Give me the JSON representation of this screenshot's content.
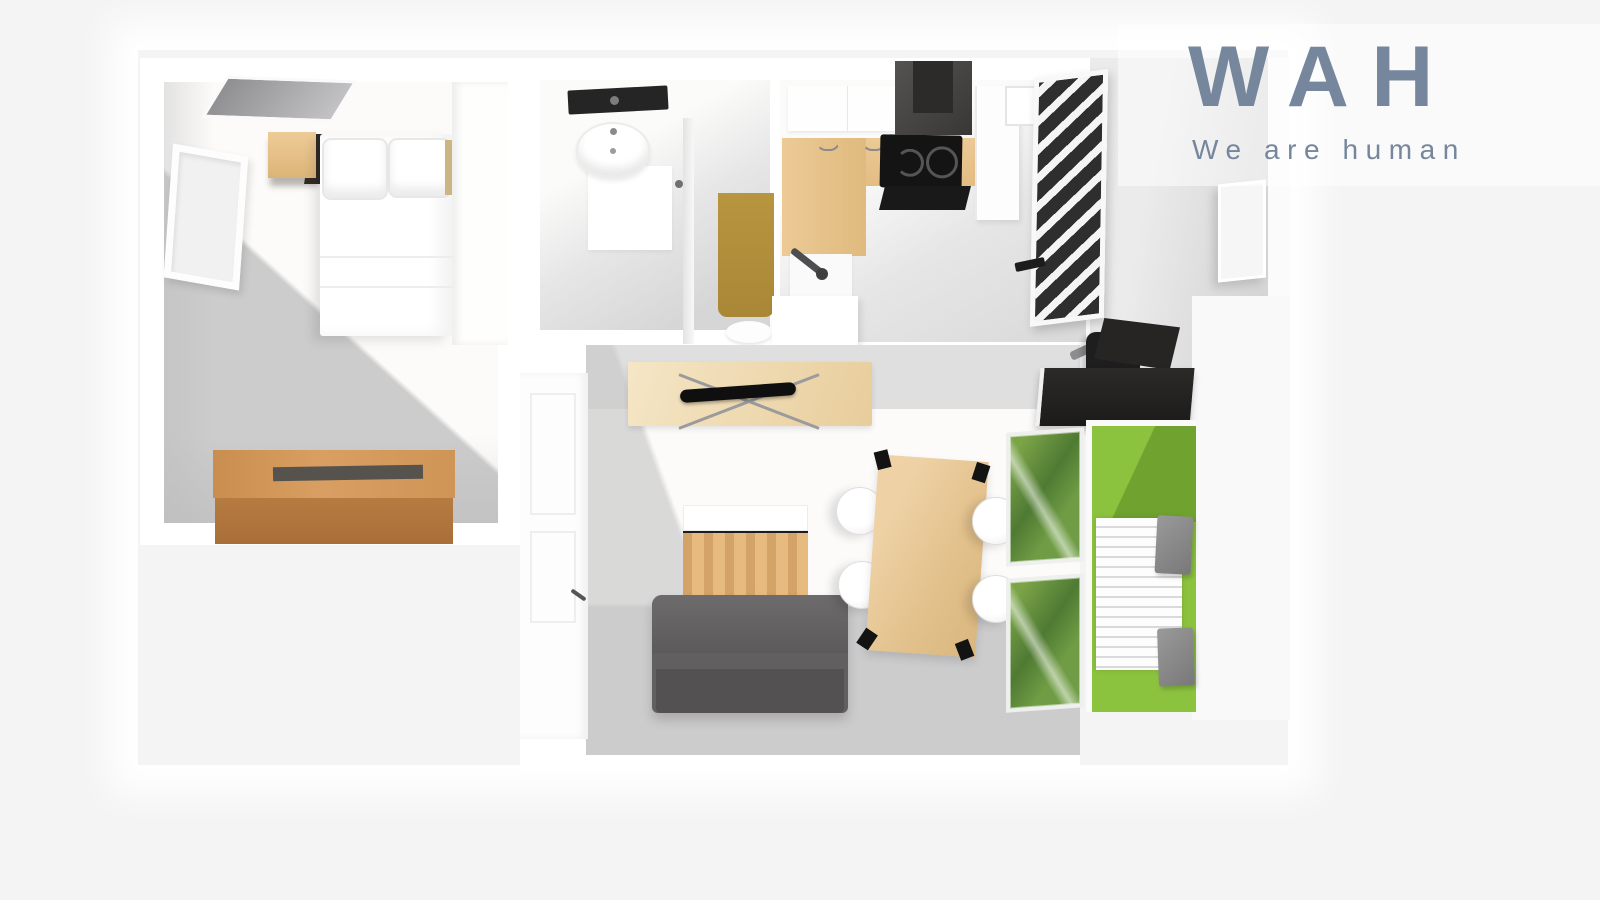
{
  "brand": {
    "name": "WAH",
    "tagline": "We are human",
    "color": "#76879D"
  },
  "scene": {
    "type": "3d-floorplan-top-view",
    "background": "#F4F4F5",
    "rooms": [
      {
        "name": "bedroom",
        "items": [
          "double-bed",
          "pillows",
          "headboard-shelf",
          "wall-tv-panel",
          "window",
          "wardrobe",
          "wooden-chest"
        ]
      },
      {
        "name": "bathroom",
        "items": [
          "rain-shower-head",
          "washbasin",
          "shower-tray",
          "tall-wooden-cabinet",
          "toilet",
          "door-handle"
        ]
      },
      {
        "name": "kitchen",
        "items": [
          "upper-cabinets",
          "l-shaped-counter",
          "induction-cooktop",
          "range-hood",
          "oven-front",
          "dishwasher",
          "sink-unit",
          "faucet",
          "fridge-cabinet",
          "window",
          "loft-ladder"
        ]
      },
      {
        "name": "living-room",
        "items": [
          "entrance-door",
          "tv-sideboard",
          "flat-tv",
          "coffee-table",
          "sofa",
          "dining-table",
          "dining-chairs-x4",
          "desk",
          "office-chair"
        ]
      },
      {
        "name": "balcony",
        "items": [
          "lawn",
          "slatted-deck",
          "outdoor-chairs-x2",
          "glass-doors"
        ]
      }
    ],
    "palette": {
      "wood_light": "#EDCD9C",
      "wood_medium": "#C98E4F",
      "wood_tan": "#B2913F",
      "sofa_gray": "#5F5D5E",
      "appliance_black": "#1A1919",
      "grass_green": "#8CC33E",
      "floor_white": "#FBFAF8",
      "shadow_gray": "#D2D2D3"
    }
  }
}
